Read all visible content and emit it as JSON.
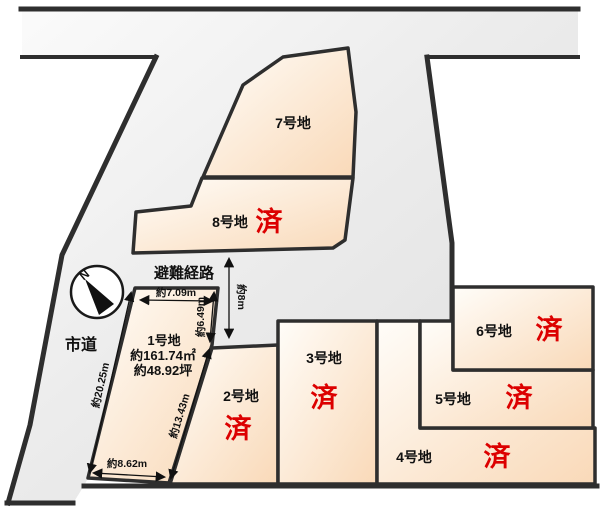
{
  "map": {
    "title": "宅地区画図",
    "compass": {
      "north": "N"
    },
    "roads": {
      "city_road": "市道",
      "evacuation_route": "避難経路",
      "evacuation_width": "約8m"
    },
    "lots": {
      "lot1": {
        "name": "1号地",
        "area_m2": "約161.74㎡",
        "area_tsubo": "約48.92坪",
        "status": "",
        "dims": {
          "top": "約7.09m",
          "right_upper": "約6.49m",
          "right_lower": "約13.43m",
          "left": "約20.25m",
          "bottom": "約8.62m"
        }
      },
      "lot2": {
        "name": "2号地",
        "status": "済"
      },
      "lot3": {
        "name": "3号地",
        "status": "済"
      },
      "lot4": {
        "name": "4号地",
        "status": "済"
      },
      "lot5": {
        "name": "5号地",
        "status": "済"
      },
      "lot6": {
        "name": "6号地",
        "status": "済"
      },
      "lot7": {
        "name": "7号地",
        "status": ""
      },
      "lot8": {
        "name": "8号地",
        "status": "済"
      }
    },
    "colors": {
      "road_fill_light": "#fbfbfb",
      "road_fill_dark": "#dedede",
      "lot_fill_light": "#fffdf9",
      "lot_fill_peach": "#f9d9b8",
      "border": "#2e2e2e",
      "sold_red": "#dc0000",
      "text": "#111111"
    }
  }
}
